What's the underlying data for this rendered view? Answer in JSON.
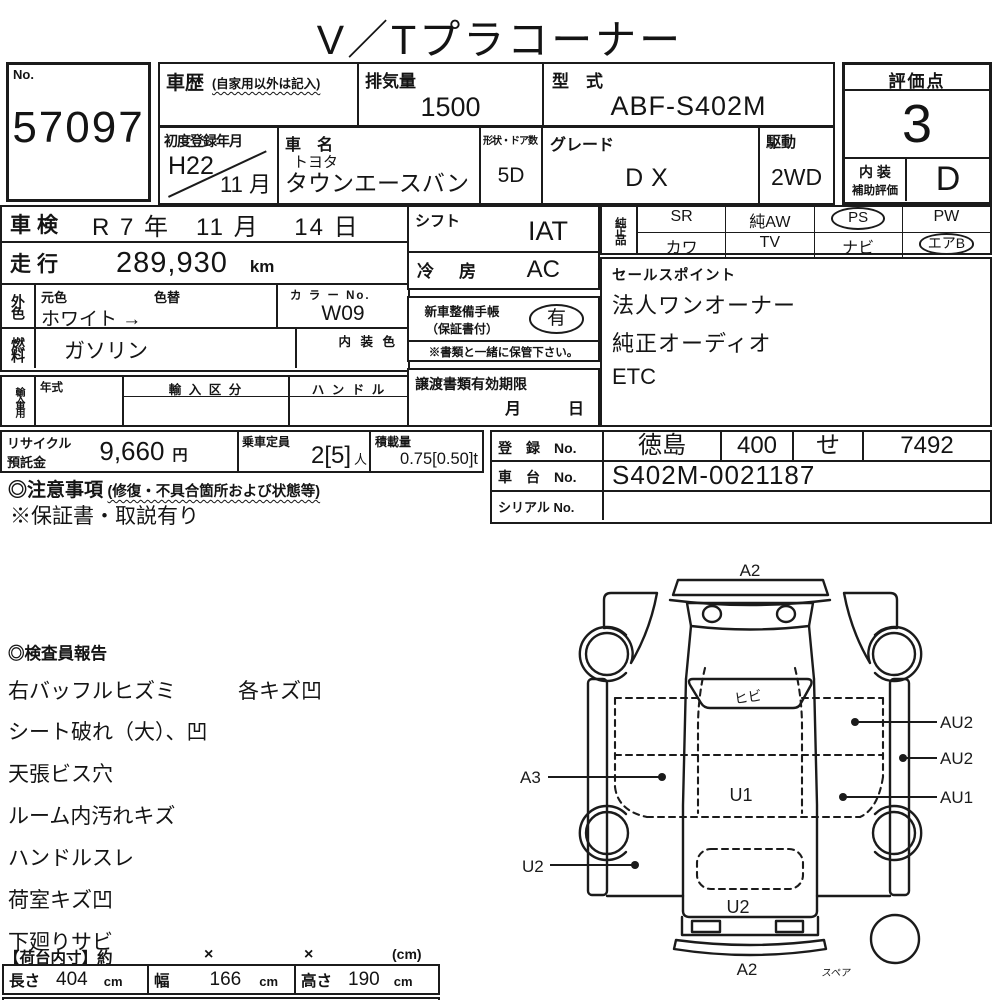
{
  "title": "V／Tプラコーナー",
  "header": {
    "no_label": "No.",
    "no_value": "57097",
    "history_label": "車歴",
    "history_note": "(自家用以外は記入)",
    "displacement_label": "排気量",
    "displacement_value": "1500",
    "model_code_label": "型　式",
    "model_code_value": "ABF-S402M",
    "score_label": "評価点",
    "score_value": "3",
    "interior_label_1": "内 装",
    "interior_label_2": "補助評価",
    "interior_grade": "D",
    "first_reg_label": "初度登録年月",
    "first_reg_year": "H22",
    "first_reg_month": "11 月",
    "car_name_label": "車　名",
    "car_maker": "トヨタ",
    "car_model": "タウンエースバン",
    "body_doors_label": "形状・ドア数",
    "body_doors_value": "5D",
    "grade_label": "グレード",
    "grade_value": "DX",
    "drive_label": "駆動",
    "drive_value": "2WD"
  },
  "main": {
    "inspection_label": "車検",
    "inspection_value": "R 7 年　11 月　 14 日",
    "mileage_label": "走行",
    "mileage_value": "289,930",
    "mileage_unit": "km",
    "ext_color_label": "外色",
    "orig_color_label": "元色",
    "color_change_label": "色替",
    "ext_color_value": "ホワイト →",
    "color_no_label": "カ ラ ー No.",
    "color_no_value": "W09",
    "fuel_label": "燃料",
    "fuel_value": "ガソリン",
    "interior_color_label": "内 装 色",
    "import_label": "輸入車用",
    "model_year_label": "年式",
    "import_class_label": "輸 入 区 分",
    "handle_label": "ハ ン ド ル",
    "shift_label": "シフト",
    "shift_value": "IAT",
    "ac_label": "冷　房",
    "ac_value": "AC",
    "service_book_label": "新車整備手帳",
    "service_book_sub": "（保証書付）",
    "service_book_value": "有",
    "keep_note": "※書類と一緒に保管下さい。",
    "transfer_label": "譲渡書類有効期限",
    "transfer_month_label": "月",
    "transfer_day_label": "日"
  },
  "equipment": {
    "label": "純正品",
    "row1": [
      "SR",
      "純AW",
      "PS",
      "PW"
    ],
    "row2": [
      "カワ",
      "TV",
      "ナビ",
      "エアB"
    ]
  },
  "sales_points": {
    "label": "セールスポイント",
    "item1": "法人ワンオーナー",
    "item2": "純正オーディオ",
    "item3": "ETC"
  },
  "recycle": {
    "label_line1": "リサイクル",
    "label_line2": "預託金",
    "value": "9,660",
    "unit": "円",
    "capacity_label": "乗車定員",
    "capacity_value": "2[5]",
    "capacity_unit": "人",
    "load_label": "積載量",
    "load_value": "0.75[0.50]t"
  },
  "registration": {
    "reg_label": "登　録　No.",
    "reg_area": "徳島",
    "reg_class": "400",
    "reg_kana": "せ",
    "reg_number": "7492",
    "chassis_label": "車　台　No.",
    "chassis_value": "S402M-0021187",
    "serial_label": "シリアル No.",
    "serial_value": ""
  },
  "notes": {
    "caution_label": "◎注意事項",
    "caution_note": "(修復・不具合箇所および状態等)",
    "warranty_note": "※保証書・取説有り"
  },
  "report": {
    "label": "◎検査員報告",
    "line1a": "右バッフルヒズミ",
    "line1b": "各キズ凹",
    "items": [
      "シート破れ（大）、凹",
      "天張ビス穴",
      "ルーム内汚れキズ",
      "ハンドルスレ",
      "荷室キズ凹",
      "下廻りサビ"
    ]
  },
  "cargo": {
    "header_label": "【荷台内寸】約",
    "x1": "×",
    "x2": "×",
    "unit_note": "(cm)",
    "length_label": "長さ",
    "length_value": "404",
    "length_unit": "cm",
    "width_label": "幅",
    "width_value": "166",
    "width_unit": "cm",
    "height_label": "高さ",
    "height_value": "190",
    "height_unit": "cm"
  },
  "diagram": {
    "front_label": "A2",
    "windshield_note": "ヒビ",
    "right_top": "AU2",
    "right_mid": "AU2",
    "right_low": "AU1",
    "left_mid": "A3",
    "center": "U1",
    "left_low": "U2",
    "rear_inner": "U2",
    "rear_label": "A2",
    "spare_label": "スペア"
  }
}
